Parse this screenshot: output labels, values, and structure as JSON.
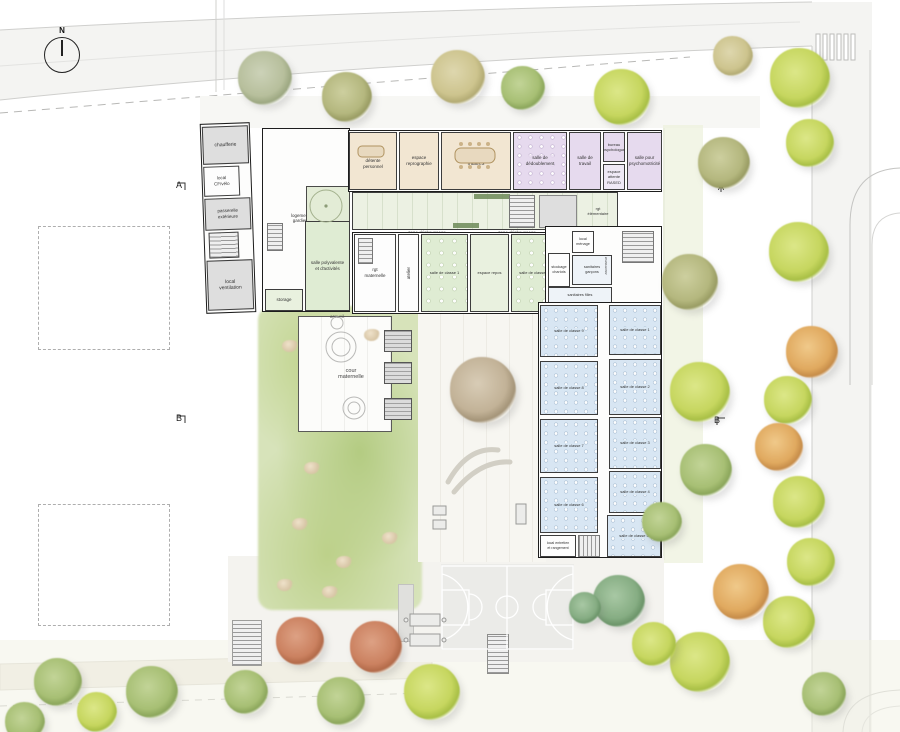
{
  "site": {
    "north": "N",
    "marker_a": "A",
    "marker_b": "B",
    "marker_c": "C"
  },
  "outdoor": {
    "cour_maternelle": "cour\nmaternelle",
    "zone_dechaussage": "zone déchaussage",
    "accueil": "accueil"
  },
  "annexe": {
    "chaufferie": "chaufferie",
    "local_cf": "local\nCF/vélo",
    "passerelle": "passerelle\nextérieure",
    "local_ventilation": "local\nventilation"
  },
  "maternelle": {
    "logement_gardien": "logement\ngardien",
    "espace_detente": "espace\ndétente\npersonnel",
    "espace_repro": "espace\nreprographie",
    "salle_maitres": "salle des\nmaîtres",
    "salle_poly": "salle polyvalente\net d'activités",
    "rgt_maternelle": "rgt\nmaternelle",
    "storage": "storage",
    "atelier": "atelier",
    "classe_1": "salle de classe 1",
    "espace_repos": "espace repos",
    "classe_2": "salle de classe 2"
  },
  "rased": {
    "salle_dedoublement": "salle de\ndédoublement",
    "salle_travail": "salle de\ntravail",
    "bureau_psy": "bureau\npsychologue",
    "espace_attente": "espace\nattente RASED",
    "salle_psychomot": "salle pour\npsychomotricité"
  },
  "elementaire": {
    "rgt": "rgt\nélémentaire",
    "stockage_chariots": "stockage\nchariots",
    "local_menage": "local\nménage",
    "sanitaires_garcons": "sanitaires\ngarçons",
    "sanitaires_filles": "sanitaires filles",
    "ascenseur": "ascenseur",
    "local_entretien": "local entretien\net rangement",
    "classes": [
      "salle de classe 1",
      "salle de classe 2",
      "salle de classe 3",
      "salle de classe 4",
      "salle de classe 5",
      "salle de classe 6",
      "salle de classe 7",
      "salle de classe 8",
      "salle de classe 9"
    ]
  },
  "colors": {
    "maternelle_green": "#dfecd3",
    "elementaire_blue": "#d8e6f3",
    "rased_purple": "#e6daee",
    "commons_tan": "#f2e6d2",
    "hall_green": "#ecf1e3"
  }
}
